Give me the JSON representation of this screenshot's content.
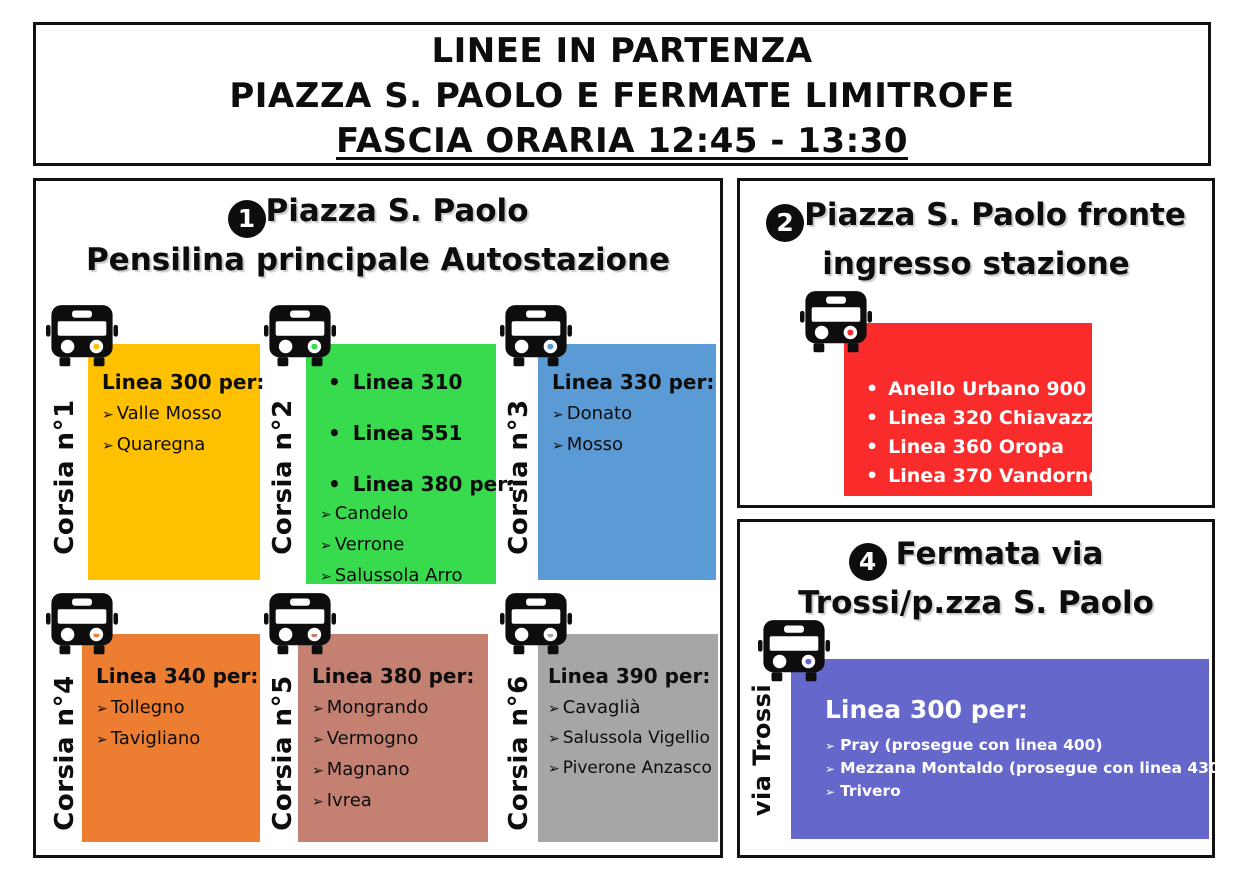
{
  "title": {
    "line1": "LINEE IN PARTENZA",
    "line2": "PIAZZA S. PAOLO E FERMATE LIMITROFE",
    "line3": "FASCIA ORARIA 12:45 - 13:30"
  },
  "icons": {
    "arrow_bullet": "➢",
    "dot_bullet": "•",
    "bus_icon": "bus-front"
  },
  "panel1": {
    "badge": "1",
    "title_line1": "Piazza S. Paolo",
    "title_line2": "Pensilina principale Autostazione",
    "stands": [
      {
        "lane": "Corsia n°1",
        "color": "#FFC000",
        "heading": "Linea 300 per:",
        "items": [
          "Valle Mosso",
          "Quaregna"
        ]
      },
      {
        "lane": "Corsia n°2",
        "color": "#38DB4D",
        "bullet_items": [
          "Linea 310",
          "Linea 551",
          "Linea 380 per:"
        ],
        "items": [
          "Candelo",
          "Verrone",
          "Salussola Arro"
        ]
      },
      {
        "lane": "Corsia n°3",
        "color": "#5B9BD5",
        "heading": "Linea 330 per:",
        "items": [
          "Donato",
          "Mosso"
        ]
      },
      {
        "lane": "Corsia n°4",
        "color": "#ED7D31",
        "heading": "Linea 340 per:",
        "items": [
          "Tollegno",
          "Tavigliano"
        ]
      },
      {
        "lane": "Corsia n°5",
        "color": "#C48071",
        "heading": "Linea 380 per:",
        "items": [
          "Mongrando",
          "Vermogno",
          "Magnano",
          "Ivrea"
        ]
      },
      {
        "lane": "Corsia n°6",
        "color": "#A6A6A6",
        "heading": "Linea 390 per:",
        "items": [
          "Cavaglià",
          "Salussola Vigellio",
          "Piverone Anzasco"
        ]
      }
    ]
  },
  "panel2": {
    "badge": "2",
    "title_line1": "Piazza S. Paolo fronte",
    "title_line2": "ingresso stazione",
    "color": "#F92B2B",
    "items": [
      "Anello Urbano 900",
      "Linea 320 Chiavazza",
      "Linea 360 Oropa",
      "Linea 370 Vandorno"
    ]
  },
  "panel4": {
    "badge": "4",
    "title_line1": "Fermata via",
    "title_line2": "Trossi/p.zza S. Paolo",
    "lane": "via Trossi",
    "color": "#6568CA",
    "heading": "Linea 300 per:",
    "items": [
      "Pray (prosegue con linea 400)",
      "Mezzana Montaldo (prosegue con linea 430)",
      "Trivero"
    ]
  }
}
